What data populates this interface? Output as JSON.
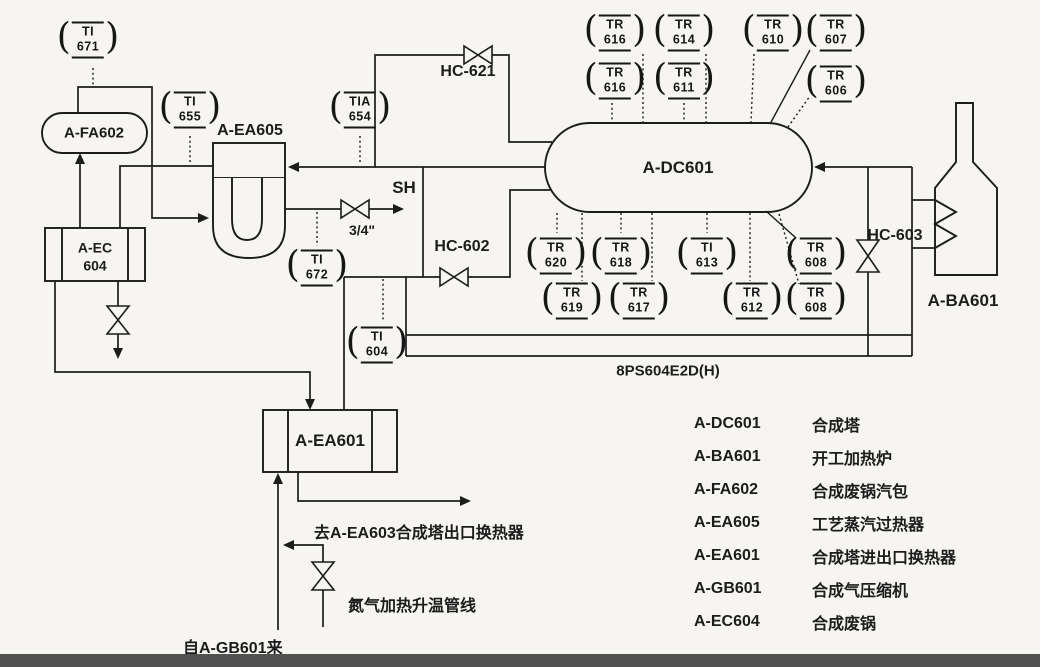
{
  "colors": {
    "ink": "#1c1c1c",
    "paper": "#f6f5f1",
    "footer_strip": "#515151"
  },
  "equipment": {
    "fa602": {
      "label": "A-FA602"
    },
    "ec604": {
      "line1": "A-EC",
      "line2": "604"
    },
    "ea605": {
      "label": "A-EA605"
    },
    "dc601": {
      "label": "A-DC601"
    },
    "ba601": {
      "label": "A-BA601"
    },
    "ea601": {
      "label": "A-EA601"
    }
  },
  "valves": {
    "hc621": {
      "label": "HC-621"
    },
    "hc602": {
      "label": "HC-602"
    },
    "hc603": {
      "label": "HC-603"
    },
    "steam_vent_size": "3/4\""
  },
  "annotations": {
    "sh": "SH",
    "pipeline_code": "8PS604E2D(H)",
    "to_ea603": "去A-EA603合成塔出口换热器",
    "nitrogen_line": "氮气加热升温管线",
    "from_gb601": "自A-GB601来"
  },
  "instruments": [
    {
      "tag": "TI",
      "num": "671",
      "x": 88,
      "y": 40
    },
    {
      "tag": "TI",
      "num": "655",
      "x": 190,
      "y": 110
    },
    {
      "tag": "TIA",
      "num": "654",
      "x": 360,
      "y": 110
    },
    {
      "tag": "TI",
      "num": "672",
      "x": 317,
      "y": 268
    },
    {
      "tag": "TI",
      "num": "604",
      "x": 377,
      "y": 345
    },
    {
      "tag": "TR",
      "num": "616",
      "x": 615,
      "y": 33
    },
    {
      "tag": "TR",
      "num": "614",
      "x": 684,
      "y": 33
    },
    {
      "tag": "TR",
      "num": "610",
      "x": 773,
      "y": 33
    },
    {
      "tag": "TR",
      "num": "607",
      "x": 836,
      "y": 33
    },
    {
      "tag": "TR",
      "num": "616",
      "x": 615,
      "y": 81
    },
    {
      "tag": "TR",
      "num": "611",
      "x": 684,
      "y": 81
    },
    {
      "tag": "TR",
      "num": "606",
      "x": 836,
      "y": 84
    },
    {
      "tag": "TR",
      "num": "620",
      "x": 556,
      "y": 256
    },
    {
      "tag": "TR",
      "num": "618",
      "x": 621,
      "y": 256
    },
    {
      "tag": "TI",
      "num": "613",
      "x": 707,
      "y": 256
    },
    {
      "tag": "TR",
      "num": "608",
      "x": 816,
      "y": 256
    },
    {
      "tag": "TR",
      "num": "619",
      "x": 572,
      "y": 301
    },
    {
      "tag": "TR",
      "num": "617",
      "x": 639,
      "y": 301
    },
    {
      "tag": "TR",
      "num": "612",
      "x": 752,
      "y": 301
    },
    {
      "tag": "TR",
      "num": "608",
      "x": 816,
      "y": 301
    }
  ],
  "legend": {
    "rows": [
      {
        "code": "A-DC601",
        "name": "合成塔"
      },
      {
        "code": "A-BA601",
        "name": "开工加热炉"
      },
      {
        "code": "A-FA602",
        "name": "合成废锅汽包"
      },
      {
        "code": "A-EA605",
        "name": "工艺蒸汽过热器"
      },
      {
        "code": "A-EA601",
        "name": "合成塔进出口换热器"
      },
      {
        "code": "A-GB601",
        "name": "合成气压缩机"
      },
      {
        "code": "A-EC604",
        "name": "合成废锅"
      }
    ]
  }
}
